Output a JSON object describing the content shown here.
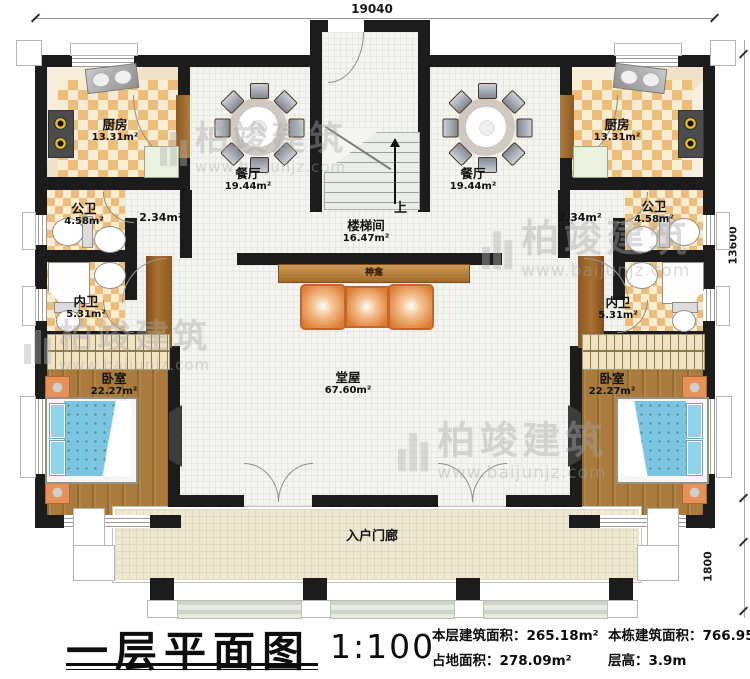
{
  "meta": {
    "plan_title": "一层平面图",
    "scale": "1:100"
  },
  "dims": {
    "top": "19040",
    "right": "13600",
    "porch": "600",
    "steps": "1800"
  },
  "stats": {
    "floor_label": "本层建筑面积：",
    "floor_value": "265.18m²",
    "ground_label": "占地面积：",
    "ground_value": "278.09m²",
    "total_label": "本栋建筑面积：",
    "total_value": "766.95m²",
    "height_label": "层高：",
    "height_value": "3.9m"
  },
  "rooms": {
    "kitchen_left": {
      "name": "厨房",
      "area": "13.31m²"
    },
    "kitchen_right": {
      "name": "厨房",
      "area": "13.31m²"
    },
    "dining_left": {
      "name": "餐厅",
      "area": "19.44m²"
    },
    "dining_right": {
      "name": "餐厅",
      "area": "19.44m²"
    },
    "pubbath_left": {
      "name": "公卫",
      "area": "4.58m²"
    },
    "pubbath_right": {
      "name": "公卫",
      "area": "4.58m²"
    },
    "corridor_left": {
      "area": "2.34m²"
    },
    "corridor_right": {
      "area": "2.34m²"
    },
    "privbath_left": {
      "name": "内卫",
      "area": "5.31m²"
    },
    "privbath_right": {
      "name": "内卫",
      "area": "5.31m²"
    },
    "bedroom_left": {
      "name": "卧室",
      "area": "22.27m²"
    },
    "bedroom_right": {
      "name": "卧室",
      "area": "22.27m²"
    },
    "stairwell": {
      "name": "楼梯间",
      "area": "16.47m²"
    },
    "stair_up": "上",
    "shrine": {
      "name": "神龛"
    },
    "main_hall": {
      "name": "堂屋",
      "area": "67.60m²"
    },
    "porch": {
      "name": "入户门廊"
    }
  },
  "wm": {
    "brand": "柏竣建筑",
    "url": "www.baijunjz.com"
  },
  "colors": {
    "wall": "#1c1c1c",
    "checker": "#ecbe7a",
    "wood": "#a97c3e",
    "bed": "#7cc5e0",
    "seat": "#dd7e33",
    "porch": "#efe9d3",
    "steps": "#d9e1d6"
  }
}
